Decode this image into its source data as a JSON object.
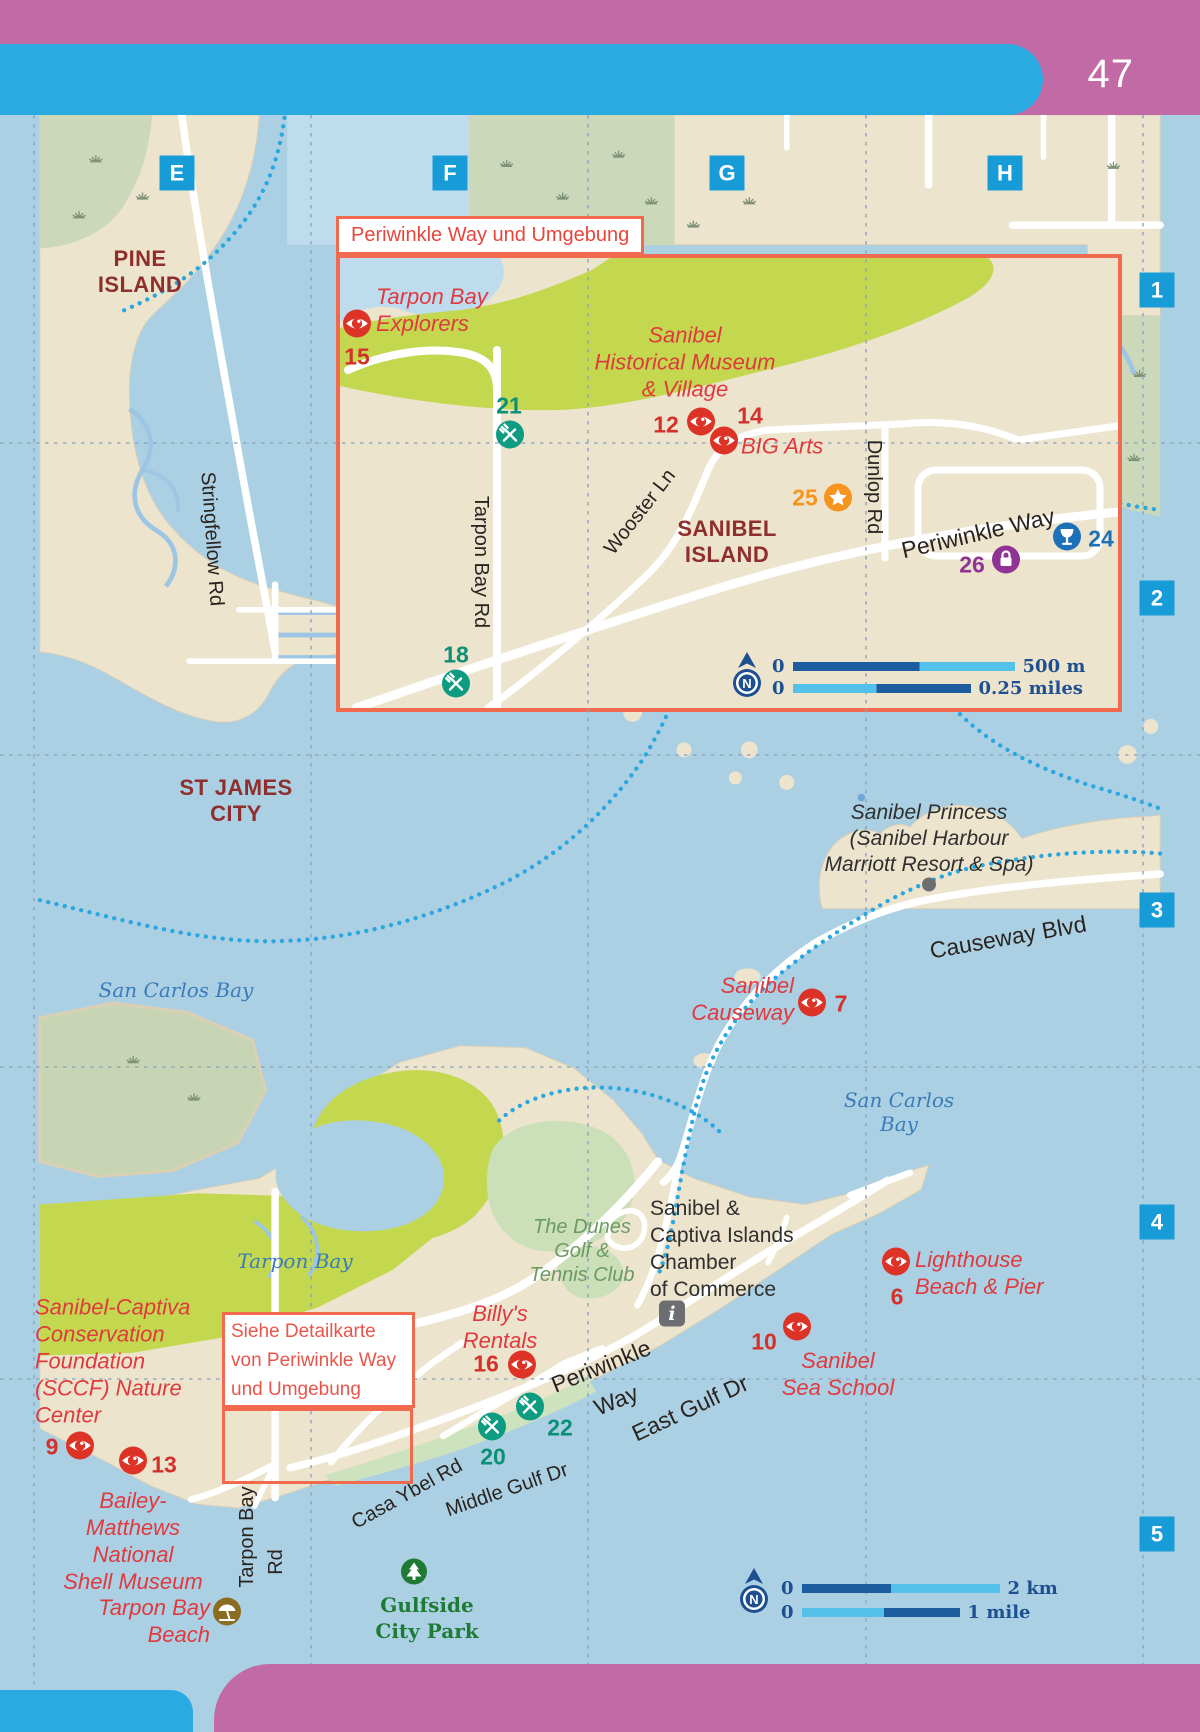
{
  "page": {
    "number": "47"
  },
  "colors": {
    "page_pink": "#C16AA5",
    "bar_blue": "#29ABE2",
    "grid_label_blue": "#189CD8",
    "sight_red": "#DD3327",
    "eat_green": "#0D9B82",
    "drink_blue": "#1D71B8",
    "shop_purple": "#8F3395",
    "fun_orange": "#F7941E",
    "info_gray": "#6D6E71",
    "park_green": "#1F7A33",
    "beach_brown": "#8A6D21",
    "scale_navy": "#1D4F91",
    "inset_orange": "#F26A4D",
    "water": "#ABD0E4",
    "land": "#EDE4CE",
    "refuge_green": "#C3D74F",
    "marsh_green": "#CBD8BA"
  },
  "grid": {
    "columns": [
      "E",
      "F",
      "G",
      "H"
    ],
    "rows": [
      "1",
      "2",
      "3",
      "4",
      "5"
    ]
  },
  "inset": {
    "title": "Periwinkle Way und Umgebung"
  },
  "detail_note": {
    "text": "Siehe Detailkarte\nvon Periwinkle Way\nund Umgebung"
  },
  "inset_scale": {
    "zero_top": "0",
    "top_label": "500 m",
    "zero_bottom": "0",
    "bottom_label": "0.25 miles"
  },
  "map_scale": {
    "zero_top": "0",
    "top_label": "2  km",
    "zero_bottom": "0",
    "bottom_label": "1 mile"
  },
  "labels": [
    {
      "name": "label-pine-island",
      "text": "PINE\nISLAND",
      "cls": "place",
      "x": 140,
      "y": 272
    },
    {
      "name": "label-st-james-city",
      "text": "ST JAMES\nCITY",
      "cls": "place",
      "x": 236,
      "y": 801
    },
    {
      "name": "label-sanibel-island",
      "text": "SANIBEL\nISLAND",
      "cls": "place",
      "x": 727,
      "y": 542
    },
    {
      "name": "label-san-carlos-bay-west",
      "text": "San Carlos Bay",
      "cls": "water",
      "x": 176,
      "y": 990
    },
    {
      "name": "label-san-carlos-bay-east",
      "text": "San Carlos\nBay",
      "cls": "water",
      "x": 899,
      "y": 1112
    },
    {
      "name": "label-tarpon-bay",
      "text": "Tarpon Bay",
      "cls": "water",
      "x": 295,
      "y": 1261
    },
    {
      "name": "label-sanibel-princess",
      "text": "Sanibel Princess\n(Sanibel Harbour\nMarriott Resort & Spa)",
      "cls": "blacki",
      "x": 929,
      "y": 839
    },
    {
      "name": "label-chamber-of-commerce",
      "text": "Sanibel &\nCaptiva Islands\nChamber\nof Commerce",
      "cls": "blackr",
      "x": 650,
      "y": 1249,
      "align": "left"
    },
    {
      "name": "label-dunes-golf",
      "text": "The Dunes\nGolf &\nTennis Club",
      "cls": "greeni",
      "x": 582,
      "y": 1251
    },
    {
      "name": "label-gulfside-city-park",
      "text": "Gulfside\nCity Park",
      "cls": "parkname",
      "x": 427,
      "y": 1618
    },
    {
      "name": "label-tarpon-bay-explorers",
      "text": "Tarpon Bay\nExplorers",
      "cls": "poi",
      "x": 376,
      "y": 310,
      "align": "left"
    },
    {
      "name": "label-historical-museum",
      "text": "Sanibel\nHistorical Museum\n& Village",
      "cls": "poi",
      "x": 685,
      "y": 362
    },
    {
      "name": "label-big-arts",
      "text": "BIG Arts",
      "cls": "poi",
      "x": 741,
      "y": 446,
      "align": "left"
    },
    {
      "name": "label-sanibel-causeway",
      "text": "Sanibel\nCauseway",
      "cls": "poi",
      "x": 794,
      "y": 999,
      "align": "right"
    },
    {
      "name": "label-lighthouse-beach",
      "text": "Lighthouse\nBeach & Pier",
      "cls": "poi",
      "x": 915,
      "y": 1273,
      "align": "left"
    },
    {
      "name": "label-sanibel-sea-school",
      "text": "Sanibel\nSea School",
      "cls": "poi",
      "x": 838,
      "y": 1374
    },
    {
      "name": "label-billys-rentals",
      "text": "Billy's\nRentals",
      "cls": "poi",
      "x": 500,
      "y": 1327
    },
    {
      "name": "label-sccf",
      "text": "Sanibel-Captiva\nConservation\nFoundation\n(SCCF) Nature\nCenter",
      "cls": "poi",
      "x": 35,
      "y": 1361,
      "align": "left"
    },
    {
      "name": "label-bailey-matthews",
      "text": "Bailey-\nMatthews\nNational\nShell Museum",
      "cls": "poi",
      "x": 133,
      "y": 1541
    },
    {
      "name": "label-tarpon-bay-beach",
      "text": "Tarpon Bay\nBeach",
      "cls": "poi",
      "x": 210,
      "y": 1621,
      "align": "right"
    },
    {
      "name": "label-stringfellow-rd",
      "text": "Stringfellow Rd",
      "cls": "road",
      "x": 212,
      "y": 539,
      "rot": 86
    },
    {
      "name": "label-tarpon-bay-rd-inset",
      "text": "Tarpon Bay Rd",
      "cls": "road",
      "x": 481,
      "y": 562,
      "rot": 90
    },
    {
      "name": "label-wooster-ln",
      "text": "Wooster Ln",
      "cls": "road",
      "x": 640,
      "y": 512,
      "rot": -52
    },
    {
      "name": "label-dunlop-rd",
      "text": "Dunlop Rd",
      "cls": "road",
      "x": 874,
      "y": 487,
      "rot": 90
    },
    {
      "name": "label-periwinkle-way-inset",
      "text": "Periwinkle Way",
      "cls": "road roadbig",
      "x": 978,
      "y": 533,
      "rot": -13
    },
    {
      "name": "label-causeway-blvd",
      "text": "Causeway Blvd",
      "cls": "road roadbig",
      "x": 1008,
      "y": 937,
      "rot": -10
    },
    {
      "name": "label-periwinkle-way-1",
      "text": "Periwinkle",
      "cls": "road roadbig",
      "x": 601,
      "y": 1366,
      "rot": -22
    },
    {
      "name": "label-periwinkle-way-2",
      "text": "Way",
      "cls": "road roadbig",
      "x": 616,
      "y": 1400,
      "rot": -22
    },
    {
      "name": "label-east-gulf-dr",
      "text": "East Gulf Dr",
      "cls": "road roadbig",
      "x": 690,
      "y": 1408,
      "rot": -25
    },
    {
      "name": "label-casa-ybel-rd",
      "text": "Casa Ybel Rd",
      "cls": "road",
      "x": 407,
      "y": 1494,
      "rot": -29
    },
    {
      "name": "label-middle-gulf-dr",
      "text": "Middle Gulf Dr",
      "cls": "road",
      "x": 507,
      "y": 1490,
      "rot": -19
    },
    {
      "name": "label-tarpon-bay-rd-south",
      "text": "Tarpon Bay",
      "cls": "road",
      "x": 247,
      "y": 1537,
      "rot": -90
    },
    {
      "name": "label-tarpon-bay-rd-south-2",
      "text": "Rd",
      "cls": "road",
      "x": 276,
      "y": 1562,
      "rot": -90
    }
  ],
  "markers": [
    {
      "name": "marker-15",
      "icon": "sight",
      "color": "red",
      "num": "15",
      "x": 357,
      "y": 326,
      "numx": 357,
      "numy": 357
    },
    {
      "name": "marker-21",
      "icon": "eating",
      "color": "green",
      "num": "21",
      "x": 510,
      "y": 437,
      "numx": 509,
      "numy": 406
    },
    {
      "name": "marker-12",
      "icon": "sight",
      "color": "red",
      "num": "12",
      "x": 701,
      "y": 424,
      "numx": 666,
      "numy": 425
    },
    {
      "name": "marker-14",
      "icon": "sight",
      "color": "red",
      "num": "14",
      "x": 724,
      "y": 443,
      "numx": 750,
      "numy": 416
    },
    {
      "name": "marker-25",
      "icon": "star",
      "color": "orange",
      "num": "25",
      "x": 838,
      "y": 500,
      "numx": 805,
      "numy": 498
    },
    {
      "name": "marker-26",
      "icon": "shopping",
      "color": "purple",
      "num": "26",
      "x": 1006,
      "y": 562,
      "numx": 972,
      "numy": 565
    },
    {
      "name": "marker-24",
      "icon": "drinking",
      "color": "blue",
      "num": "24",
      "x": 1067,
      "y": 539,
      "numx": 1101,
      "numy": 539
    },
    {
      "name": "marker-18",
      "icon": "eating",
      "color": "green",
      "num": "18",
      "x": 456,
      "y": 686,
      "numx": 456,
      "numy": 655
    },
    {
      "name": "marker-7",
      "icon": "sight",
      "color": "red",
      "num": "7",
      "x": 812,
      "y": 1005,
      "numx": 841,
      "numy": 1004
    },
    {
      "name": "marker-6",
      "icon": "sight",
      "color": "red",
      "num": "6",
      "x": 896,
      "y": 1264,
      "numx": 897,
      "numy": 1297
    },
    {
      "name": "marker-10",
      "icon": "sight",
      "color": "red",
      "num": "10",
      "x": 797,
      "y": 1329,
      "numx": 764,
      "numy": 1342
    },
    {
      "name": "marker-16",
      "icon": "sight",
      "color": "red",
      "num": "16",
      "x": 522,
      "y": 1367,
      "numx": 486,
      "numy": 1364
    },
    {
      "name": "marker-22",
      "icon": "eating",
      "color": "green",
      "num": "22",
      "x": 530,
      "y": 1409,
      "numx": 560,
      "numy": 1428
    },
    {
      "name": "marker-20",
      "icon": "eating",
      "color": "green",
      "num": "20",
      "x": 492,
      "y": 1429,
      "numx": 493,
      "numy": 1457
    },
    {
      "name": "marker-9",
      "icon": "sight",
      "color": "red",
      "num": "9",
      "x": 80,
      "y": 1448,
      "numx": 52,
      "numy": 1447
    },
    {
      "name": "marker-13",
      "icon": "sight",
      "color": "red",
      "num": "13",
      "x": 133,
      "y": 1463,
      "numx": 164,
      "numy": 1465
    },
    {
      "name": "icon-chamber-info",
      "icon": "info",
      "x": 672,
      "y": 1316
    },
    {
      "name": "icon-gulfside-tree",
      "icon": "tree",
      "x": 414,
      "y": 1574
    },
    {
      "name": "icon-tarpon-bay-beach",
      "icon": "beach",
      "x": 227,
      "y": 1614
    },
    {
      "name": "icon-princess-dot",
      "icon": "dot",
      "x": 929,
      "y": 887
    }
  ]
}
